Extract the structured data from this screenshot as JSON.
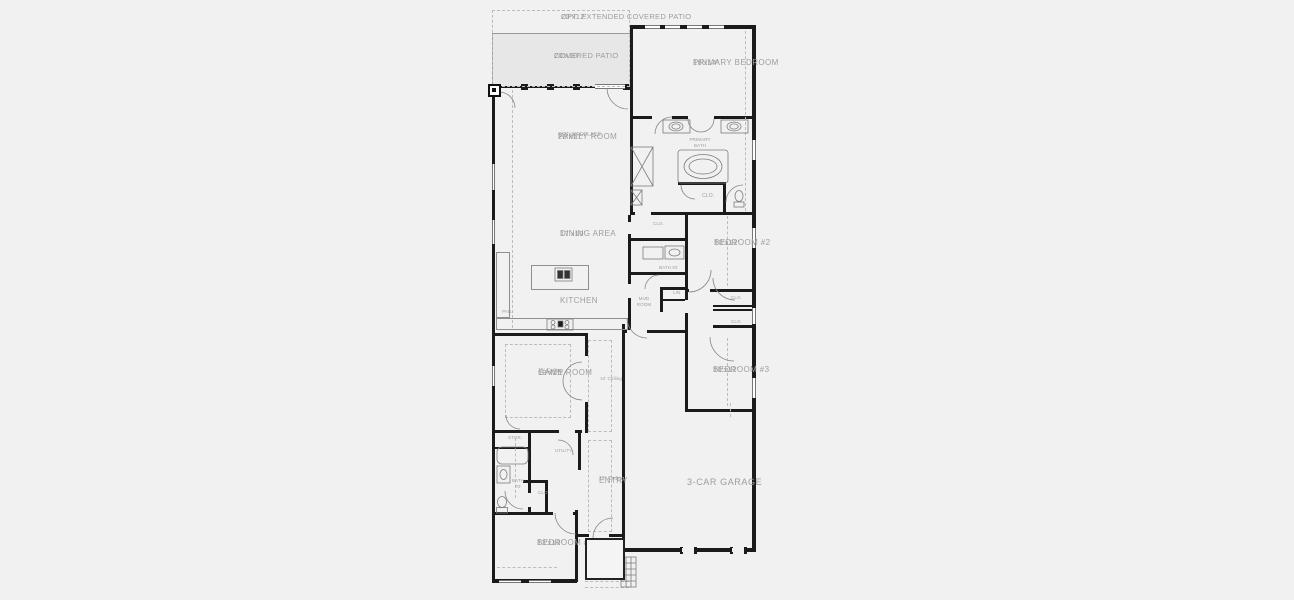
{
  "plan": {
    "opt_patio": {
      "name": "OPT. EXTENDED COVERED PATIO",
      "dims": "20'x12'"
    },
    "covered_patio": {
      "name": "COVERED PATIO",
      "dims": "20'x10'"
    },
    "primary_bedroom": {
      "name": "PRIMARY BEDROOM",
      "dims": "18'x14'"
    },
    "family_room": {
      "name": "FAMILY ROOM",
      "note": "OPT. FIREPLACE",
      "dims": "20'x17'"
    },
    "primary_bath": {
      "name": "PRIMARY BATH"
    },
    "dining": {
      "name": "DINING AREA",
      "dims": "17'x10'"
    },
    "kitchen": {
      "name": "KITCHEN"
    },
    "pantry": {
      "name": "PAN."
    },
    "primary_closet": {
      "name": "CLO."
    },
    "bed2_closet": {
      "name": "CLO."
    },
    "bath2": {
      "name": "BATH #2"
    },
    "bedroom2": {
      "name": "BEDROOM #2",
      "dims": "10'x12'"
    },
    "mud_room": {
      "name": "MUD ROOM"
    },
    "linen": {
      "name": "LIN."
    },
    "hall_closet": {
      "name": "CLO."
    },
    "bed3_closet": {
      "name": "CLO."
    },
    "bedroom3": {
      "name": "BEDROOM #3",
      "dims": "10'x12'"
    },
    "game_room": {
      "name": "GAME ROOM",
      "dims": "13'x15'",
      "note": "11' Ceiling"
    },
    "hall": {
      "note": "10' Ceiling"
    },
    "storage": {
      "name": "STOR."
    },
    "utility": {
      "name": "UTILITY"
    },
    "bath3": {
      "name": "BATH #3"
    },
    "entry_closet": {
      "name": "CLO."
    },
    "entry": {
      "name": "ENTRY",
      "note": "12' Ceiling"
    },
    "garage": {
      "name": "3-CAR GARAGE"
    },
    "bedroom4": {
      "name": "BEDROOM #4",
      "dims": "13'x10'"
    },
    "porch": {
      "name": "PORCH"
    }
  },
  "colors": {
    "background": "#f1f1f1",
    "wall": "#1b1b1b",
    "label_text": "#9d9d9d",
    "patio_fill": "#e7e7e7",
    "dashed_line": "#bcbcbc"
  }
}
